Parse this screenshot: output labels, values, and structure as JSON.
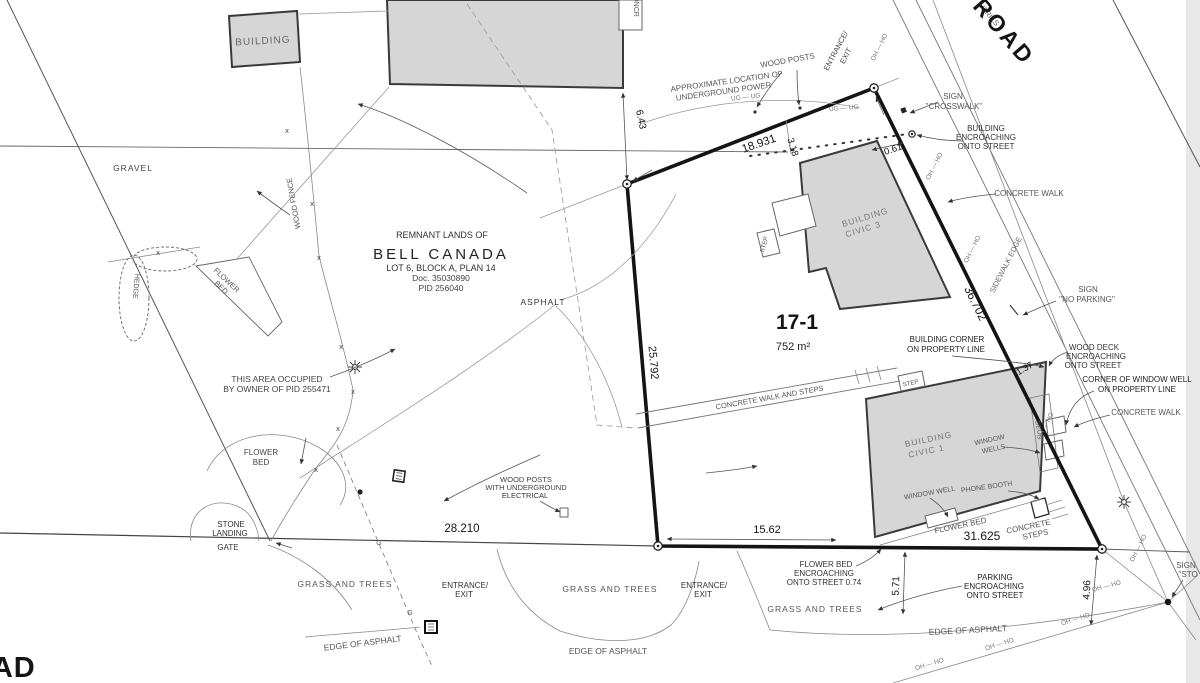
{
  "drawing_type": "legal survey site plan",
  "colors": {
    "paper": "#ffffff",
    "building_fill": "#d6d6d6",
    "boundary": "#141414",
    "thin_line": "#888888",
    "label_text": "#555555",
    "dark_text": "#141414",
    "edge_strip": "#e8e8e8"
  },
  "labels": {
    "building": "BUILDING",
    "concrete_pad": "CONCR",
    "gravel": "GRAVEL",
    "wood_fence": "WOOD FENCE",
    "remnant": "REMNANT LANDS OF",
    "bell_canada": "BELL CANADA",
    "lot": "LOT 6, BLOCK A, PLAN 14",
    "doc": "Doc. 35030890",
    "pid": "PID 256040",
    "asphalt": "ASPHALT",
    "hedge": "HEDGE",
    "flower": "FLOWER",
    "bed": "BED",
    "flower_bed": "FLOWER BED",
    "this_area1": "THIS AREA OCCUPIED",
    "this_area2": "BY OWNER OF PID 255471",
    "stone": "STONE",
    "landing": "LANDING",
    "gate": "GATE",
    "grass_trees": "GRASS AND TREES",
    "entrance": "ENTRANCE/",
    "exit": "EXIT",
    "edge_of_asphalt": "EDGE OF ASPHALT",
    "wood_posts": "WOOD POSTS",
    "with_underground": "WITH UNDERGROUND",
    "electrical": "ELECTRICAL",
    "approx1": "APPROXIMATE LOCATION OF",
    "approx2": "UNDERGROUND POWER",
    "sign": "SIGN",
    "crosswalk": "''CROSSWALK''",
    "no_parking": "''NO PARKING''",
    "stop_partial": "''STO",
    "building_word": "BUILDING",
    "encroaching": "ENCROACHING",
    "onto_street": "ONTO STREET",
    "onto_street_074": "ONTO STREET 0.74",
    "concrete_walk": "CONCRETE WALK",
    "sidewalk_edge": "SIDEWALK EDGE",
    "building_corner": "BUILDING CORNER",
    "on_property_line": "ON PROPERTY LINE",
    "wood_deck": "WOOD DECK",
    "corner_of_ww": "CORNER OF WINDOW WELL",
    "cw_and_steps": "CONCRETE WALK AND STEPS",
    "step": "STEP",
    "civic3": "CIVIC 3",
    "civic1": "CIVIC 1",
    "window": "WINDOW",
    "wells": "WELLS",
    "window_well": "WINDOW WELL",
    "phone_booth": "PHONE BOOTH",
    "concrete": "CONCRETE",
    "steps": "STEPS",
    "parking": "PARKING",
    "deck": "DECK",
    "oh_ho": "OH — HO",
    "ug_ug": "UG — UG",
    "varies": "VARIES",
    "road_name_partial": "OINT ROAD",
    "road_bottom_partial": "OAD",
    "parcel_id": "17-1",
    "parcel_area": "752 m²",
    "x_mark": "x",
    "g_mark": "G"
  },
  "dims": {
    "d643": "6.43",
    "d18931": "18.931",
    "d318": "3.18",
    "d061": "0.61",
    "d25792": "25.792",
    "d36702": "36.702",
    "d137": "1.37",
    "d28210": "28.210",
    "d1562": "15.62",
    "d31625": "31.625",
    "d571": "5.71",
    "d496": "4.96"
  }
}
